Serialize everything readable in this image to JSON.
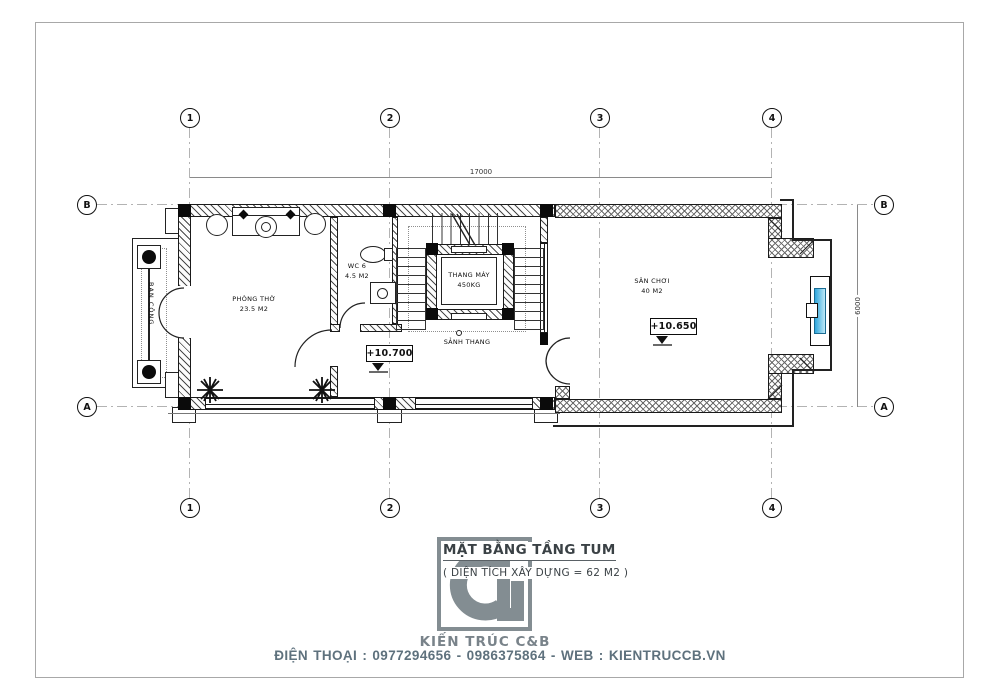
{
  "plan": {
    "grid": {
      "cols": [
        "1",
        "2",
        "3",
        "4"
      ],
      "rows": [
        "B",
        "A"
      ]
    },
    "dims": {
      "width": "17000",
      "height": "6000"
    },
    "rooms": {
      "phong_tho": {
        "name": "PHÒNG THỜ",
        "area": "23.5 M2"
      },
      "wc": {
        "name": "WC 6",
        "area": "4.5 M2"
      },
      "elevator": {
        "name": "THANG MÁY",
        "capacity": "450KG"
      },
      "sanh_thang": {
        "name": "SẢNH THANG"
      },
      "san_choi": {
        "name": "SÂN CHƠI",
        "area": "40 M2"
      },
      "ban_cong": {
        "name": "BAN CÔNG"
      }
    },
    "levels": {
      "hall": "+10.700",
      "san_choi": "+10.650"
    }
  },
  "title_block": {
    "title": "MẶT BẰNG TẦNG TUM",
    "subtitle": "( DIỆN TÍCH XÂY DỰNG = 62 M2 )",
    "brand": "KIẾN TRÚC C&B",
    "monogram": "CB"
  },
  "footer": {
    "contact": "ĐIỆN THOẠI : 0977294656 - 0986375864 - WEB : KIENTRUCCB.VN"
  },
  "colors": {
    "window_glass": "#3fb0e0",
    "brand_gray": "#7e878d",
    "footer_text": "#5e717d"
  }
}
